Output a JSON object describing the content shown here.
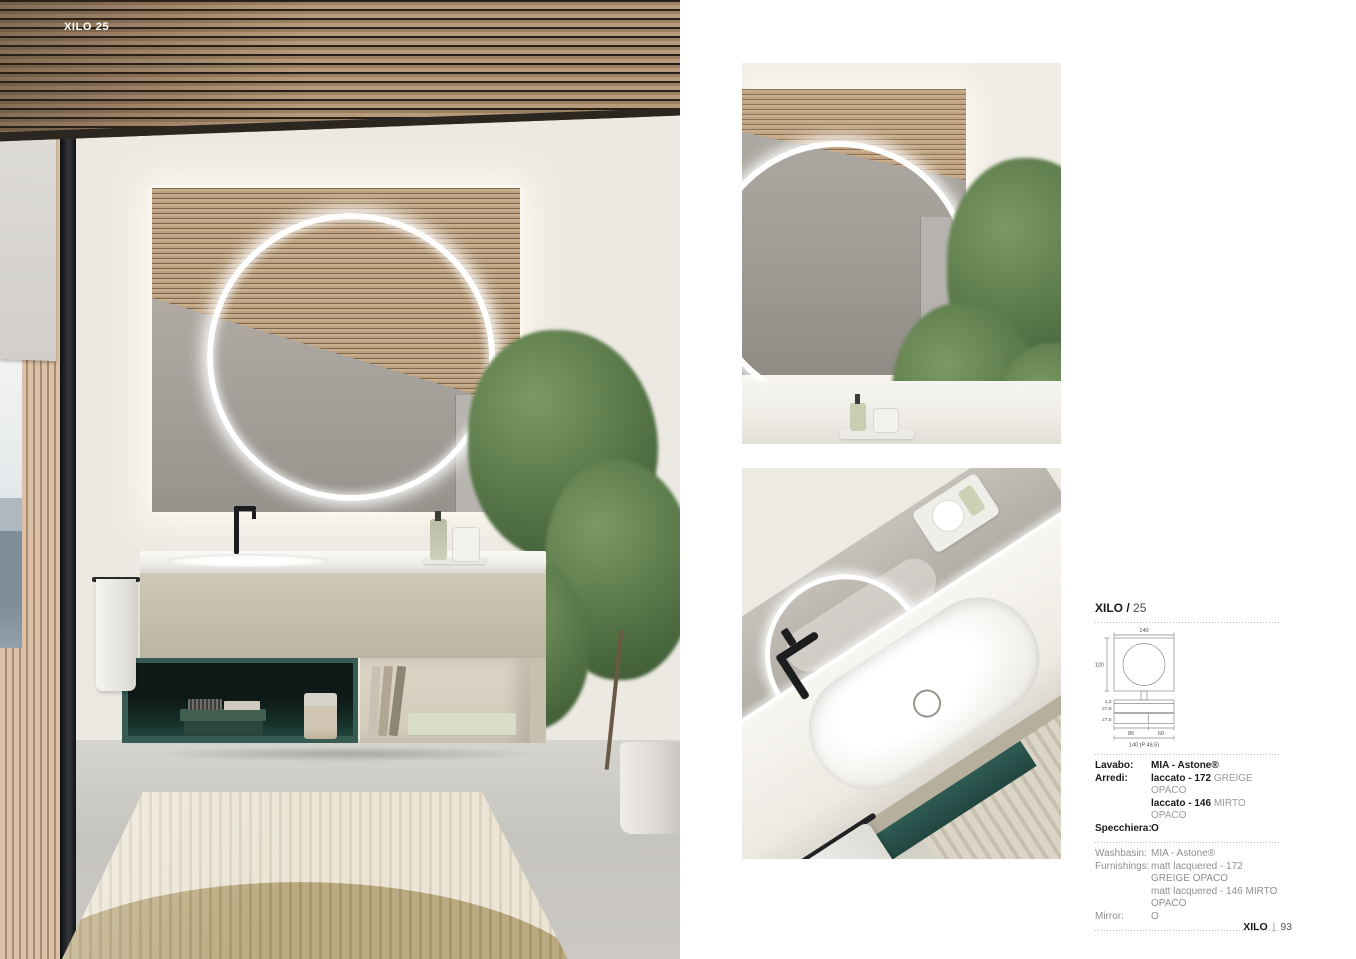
{
  "page": {
    "hero_label": "XILO 25",
    "footer": {
      "brand": "XILO",
      "separator": "|",
      "page_number": "93"
    }
  },
  "spec_panel": {
    "title_model": "XILO /",
    "title_number": "25",
    "drawing": {
      "mirror_width": "140",
      "mirror_height": "120",
      "counter_thickness": "1,2",
      "unit_height_top": "27,5",
      "unit_height_bottom": "27,5",
      "module_width_left": "80",
      "module_width_right": "60",
      "overall_width_depth": "140 (P 46,5)"
    },
    "it": {
      "rows": [
        {
          "label": "Lavabo:",
          "bold": "MIA - Astone®",
          "grey": ""
        },
        {
          "label": "Arredi:",
          "bold": "laccato - 172",
          "grey": " GREIGE OPACO"
        },
        {
          "label": "",
          "bold": "laccato - 146",
          "grey": " MIRTO OPACO"
        },
        {
          "label": "Specchiera:",
          "bold": "O",
          "grey": ""
        }
      ]
    },
    "en": {
      "rows": [
        {
          "label": "Washbasin:",
          "value": "MIA - Astone®"
        },
        {
          "label": "Furnishings:",
          "value": "matt lacquered - 172 GREIGE OPACO"
        },
        {
          "label": "",
          "value": "matt lacquered - 146 MIRTO OPACO"
        },
        {
          "label": "Mirror:",
          "value": "O"
        }
      ]
    }
  },
  "colors": {
    "mirto_teal": "#2F5B53",
    "greige": "#C9C1B0",
    "wood": "#B2957A",
    "wall_cream": "#ECE9E2",
    "text_grey": "#8F8F8F"
  }
}
